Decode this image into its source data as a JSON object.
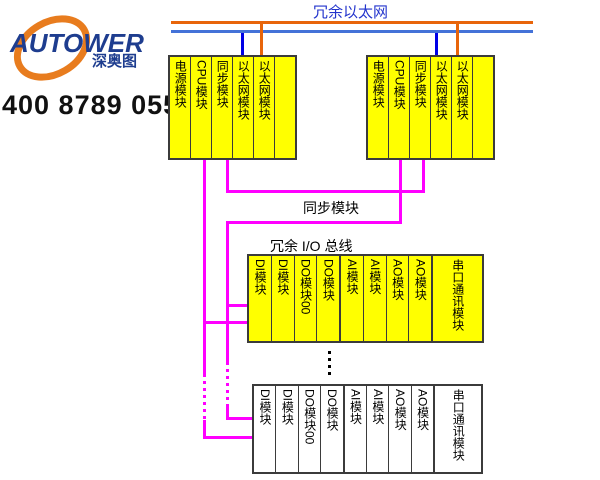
{
  "brand": {
    "logo_text": "AUTOWER",
    "logo_cn": "深奥图",
    "phone": "400 8789 055",
    "logo_color": "#1e3d8f",
    "swoosh_color": "#e87c1e"
  },
  "ethernet": {
    "label": "冗余以太网",
    "line_a_color": "#e8650a",
    "line_b_color": "#4472d8",
    "drop_blue_color": "#0000e6"
  },
  "labels": {
    "sync_link": "同步模块",
    "io_bus": "冗余 I/O 总线"
  },
  "bus_color": "#ff00ff",
  "module_fill_yellow": "#ffff00",
  "module_fill_white": "#ffffff",
  "controller_groups": [
    {
      "name": "controller-a",
      "modules": [
        "电源模块",
        "CPU模块",
        "同步模块",
        "以太网模块",
        "以太网模块",
        ""
      ]
    },
    {
      "name": "controller-b",
      "modules": [
        "电源模块",
        "CPU模块",
        "同步模块",
        "以太网模块",
        "以太网模块",
        ""
      ]
    }
  ],
  "io_racks": [
    {
      "name": "io-rack-top",
      "modules": [
        "DI模块",
        "DI模块",
        "DO模块00",
        "DO模块",
        "AI模块",
        "AI模块",
        "AO模块",
        "AO模块",
        "串口通讯模块"
      ]
    },
    {
      "name": "io-rack-bottom",
      "modules": [
        "DI模块",
        "DI模块",
        "DO模块00",
        "DO模块",
        "AI模块",
        "AI模块",
        "AO模块",
        "AO模块",
        "串口通讯模块"
      ]
    }
  ]
}
